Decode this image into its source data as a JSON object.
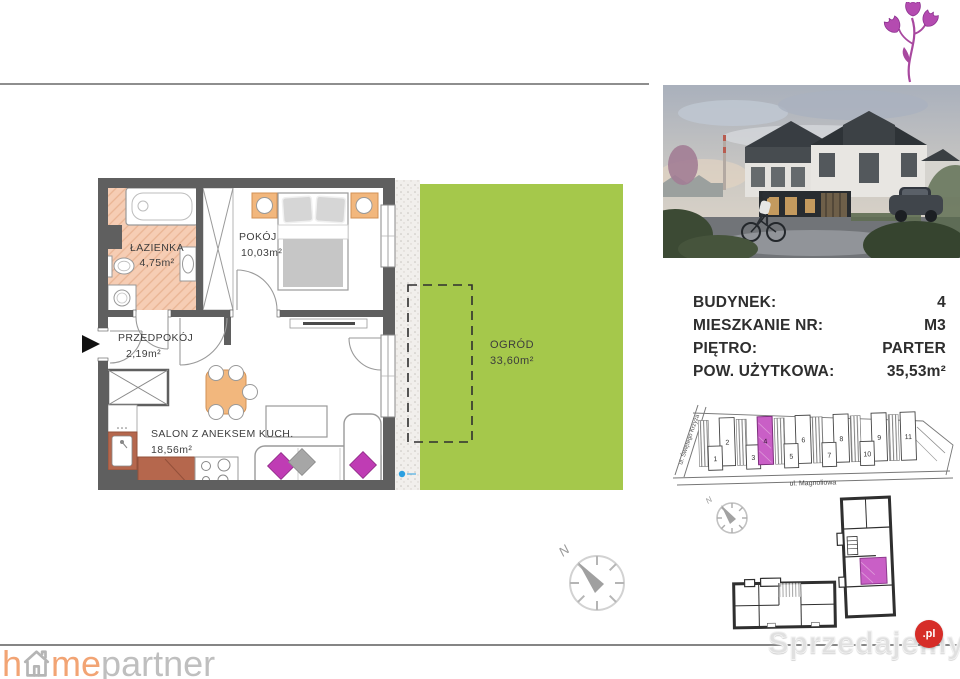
{
  "floor_plan": {
    "rooms": [
      {
        "name": "ŁAZIENKA",
        "area": "4,75m²"
      },
      {
        "name": "POKÓJ",
        "area": "10,03m²"
      },
      {
        "name": "PRZEDPOKÓJ",
        "area": "2,19m²"
      },
      {
        "name": "SALON Z ANEKSEM KUCH.",
        "area": "18,56m²"
      }
    ],
    "garden": {
      "name": "OGRÓD",
      "area": "33,60m²"
    }
  },
  "details": {
    "rows": [
      {
        "label": "BUDYNEK:",
        "value": "4"
      },
      {
        "label": "MIESZKANIE NR:",
        "value": "M3"
      },
      {
        "label": "PIĘTRO:",
        "value": "PARTER"
      },
      {
        "label": "POW. UŻYTKOWA:",
        "value": "35,53m²"
      }
    ]
  },
  "site_map": {
    "street_left": "ul. Świętego Krzyża",
    "street_bottom": "ul. Magnoliowa",
    "buildings": [
      "1",
      "2",
      "3",
      "4",
      "5",
      "6",
      "7",
      "8",
      "9",
      "10",
      "11"
    ],
    "highlighted_building": "4"
  },
  "compass": {
    "north": "N"
  },
  "branding": {
    "homepartner_h": "h",
    "homepartner_me": "me",
    "homepartner_partner": "partner",
    "watermark_text": "Sprzedajemy",
    "watermark_suffix": ".pl"
  },
  "colors": {
    "garden_green": "#a5c84b",
    "bathroom_peach": "#f6cdb4",
    "wall_gray": "#5f5f5f",
    "accent_magenta": "#bf3cb4",
    "kitchen_brown": "#b5674d",
    "wood_orange": "#f2b77d",
    "badge_red": "#d62d28",
    "logo_orange": "#f2a474",
    "logo_gray": "#bfbfbf"
  }
}
